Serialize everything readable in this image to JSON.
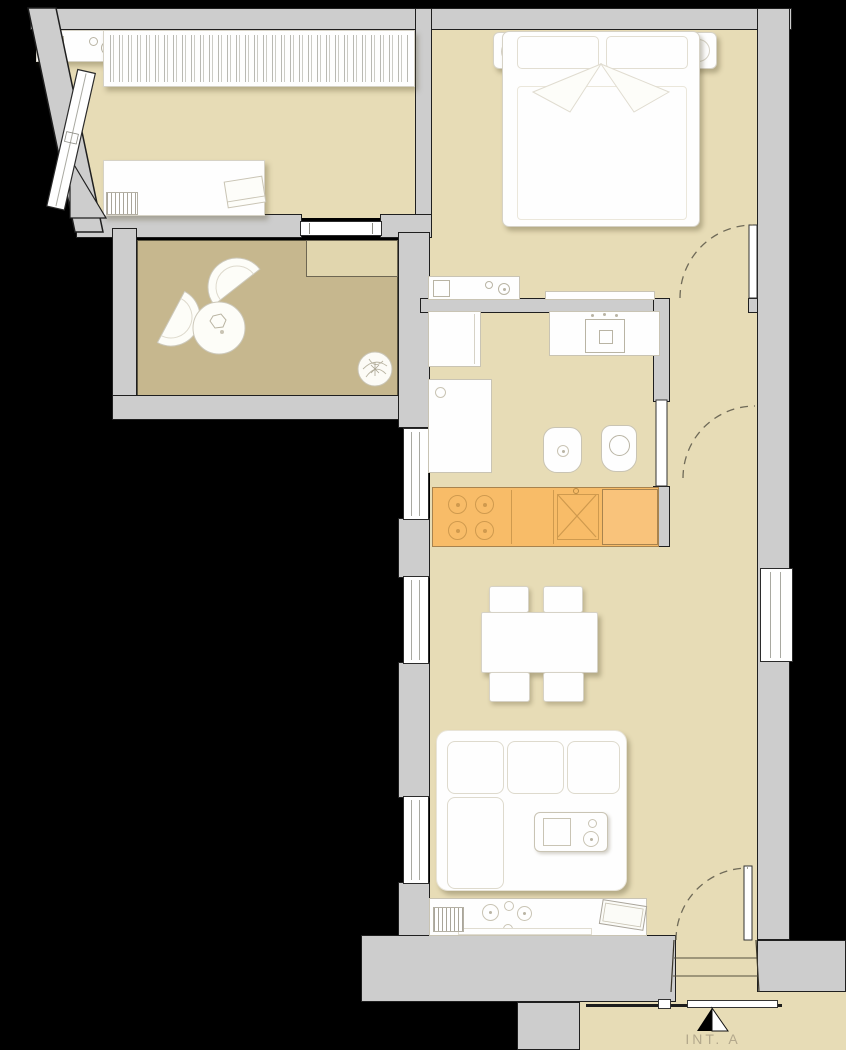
{
  "meta": {
    "drawing_type": "apartment floor plan",
    "unit_label": "INT. A"
  },
  "entrance": {
    "marker": "half-filled-triangle",
    "visible_steps": 2
  },
  "palette": {
    "background": "#000000",
    "wall_fill": "#cdcdcd",
    "wall_outline": "#1f1f1f",
    "floor": "#e7dcb6",
    "terrace_floor": "#c6b78e",
    "landing": "#e1d6ae",
    "kitchen_counter": "#f8bc68",
    "kitchen_line": "#cf9a4e",
    "furniture": "#fefefe",
    "furniture_line": "#d6d2c6",
    "door_arc": "#6f6a58",
    "label_text": "#b3a88c"
  }
}
